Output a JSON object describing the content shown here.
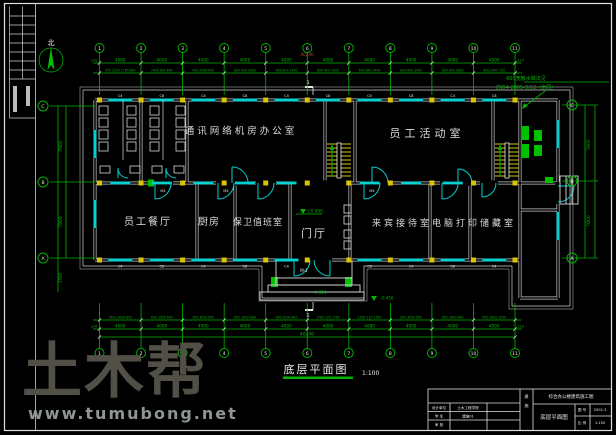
{
  "compass": {
    "label": "北"
  },
  "grid": {
    "top_numbers": [
      "1",
      "2",
      "3",
      "4",
      "5",
      "6",
      "7",
      "8",
      "9",
      "10",
      "11"
    ],
    "bottom_numbers": [
      "1",
      "2",
      "3",
      "4",
      "5",
      "6",
      "7",
      "8",
      "9",
      "10",
      "11"
    ],
    "left_letters": [
      "C",
      "B",
      "A"
    ],
    "right_letters": [
      "C",
      "B",
      "A"
    ],
    "bay_dim": "4000",
    "edge_dim": "120",
    "top_total": "40240",
    "bottom_total": "40240",
    "top_detail_dims": [
      "150 1500 1750 600",
      "2400 600 800",
      "600 2400 600",
      "800 600 2400",
      "600 800 2400",
      "800 600 2400",
      "600 800 2400",
      "800 600 2400",
      "600 800 2400",
      "600 2400 150"
    ],
    "bottom_detail_dims": [
      "1500 3000 600",
      "600 3000 600",
      "600 3000 600",
      "600 3000 600",
      "600 3000 600",
      "1760 120 1760",
      "1760 120 1760",
      "600 3000 600",
      "600 3000 600",
      "600 3000 1500"
    ],
    "left_dims": [
      "7800",
      "7800",
      "1500"
    ],
    "right_dims": [
      "7800",
      "7800"
    ]
  },
  "rooms": [
    {
      "name": "通讯网络机房办公室"
    },
    {
      "name": "员工活动室"
    },
    {
      "name": "员工餐厅"
    },
    {
      "name": "厨房"
    },
    {
      "name": "保卫值班室"
    },
    {
      "name": "门厅"
    },
    {
      "name": "来宾接待室电脑打印储藏室"
    }
  ],
  "window_labels": {
    "top": [
      "C4",
      "C8",
      "C4",
      "C8",
      "C4",
      "C8",
      "C4",
      "C8",
      "C4",
      "C8"
    ],
    "bottom": [
      "C4",
      "C8",
      "C4",
      "C8",
      "C4",
      "",
      "C8",
      "C4",
      "C8",
      "C4"
    ]
  },
  "door_labels": {
    "entrance": "M-1",
    "room": "M4"
  },
  "levels": {
    "zero": "±0.000",
    "entry": "-0.020",
    "ground": "-0.450"
  },
  "section": {
    "mark": "1"
  },
  "apron_note": {
    "line1": "600宽散水做法见",
    "line2": "苏J04-2005-3/12（余同）"
  },
  "plan_title": {
    "text": "底层平面图",
    "scale": "1:100"
  },
  "watermark": {
    "big": "土木帮",
    "url": "www.tumubong.net"
  },
  "title_block": {
    "project": "综合办公楼建筑施工图",
    "drawing_name": "底层平面图",
    "side_label": "建施",
    "rows": [
      [
        "设计单位",
        "土木工程学院"
      ],
      [
        "学 生",
        "建施01"
      ],
      [
        "审 核",
        ""
      ]
    ],
    "right_cells": [
      [
        "图 号",
        "2002-3"
      ],
      [
        "比 例",
        "1:100"
      ]
    ]
  },
  "colors": {
    "green": "#00b400",
    "cyan": "#00d2d2",
    "yellow": "#d8c400",
    "red": "#c04040",
    "white": "#e8e8e8"
  }
}
